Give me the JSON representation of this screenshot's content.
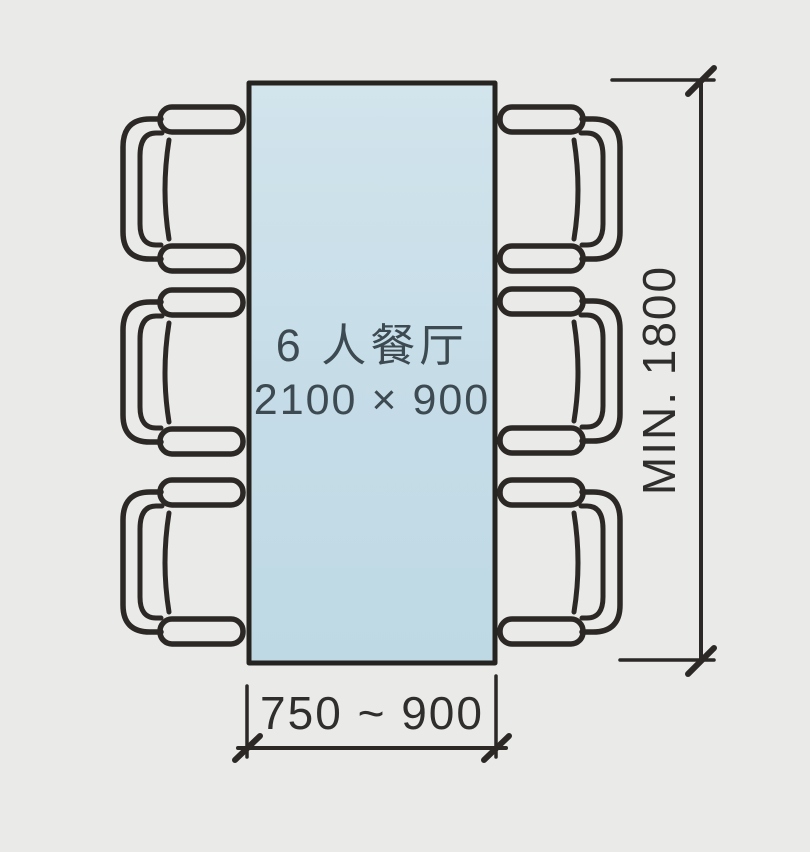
{
  "diagram": {
    "type": "dining-room-furniture-plan",
    "table": {
      "label": "6 人餐厅",
      "size_label": "2100 × 900",
      "seats": 6,
      "fill_color": "#c6dde8",
      "outline_color": "#2b2826"
    },
    "chairs": {
      "count": 6,
      "left_column": 3,
      "right_column": 3
    },
    "dimensions": {
      "vertical_clearance": {
        "label": "MIN. 1800",
        "orientation": "vertical"
      },
      "horizontal_clearance": {
        "label": "750 ~ 900",
        "orientation": "horizontal"
      }
    },
    "colors": {
      "background": "#eaeae8",
      "ink": "#2b2826",
      "table_fill_top": "#d2e4ec",
      "table_fill_bottom": "#bed9e4",
      "table_text": "#3d4a51",
      "dimension_text": "#2f2e2c"
    }
  }
}
